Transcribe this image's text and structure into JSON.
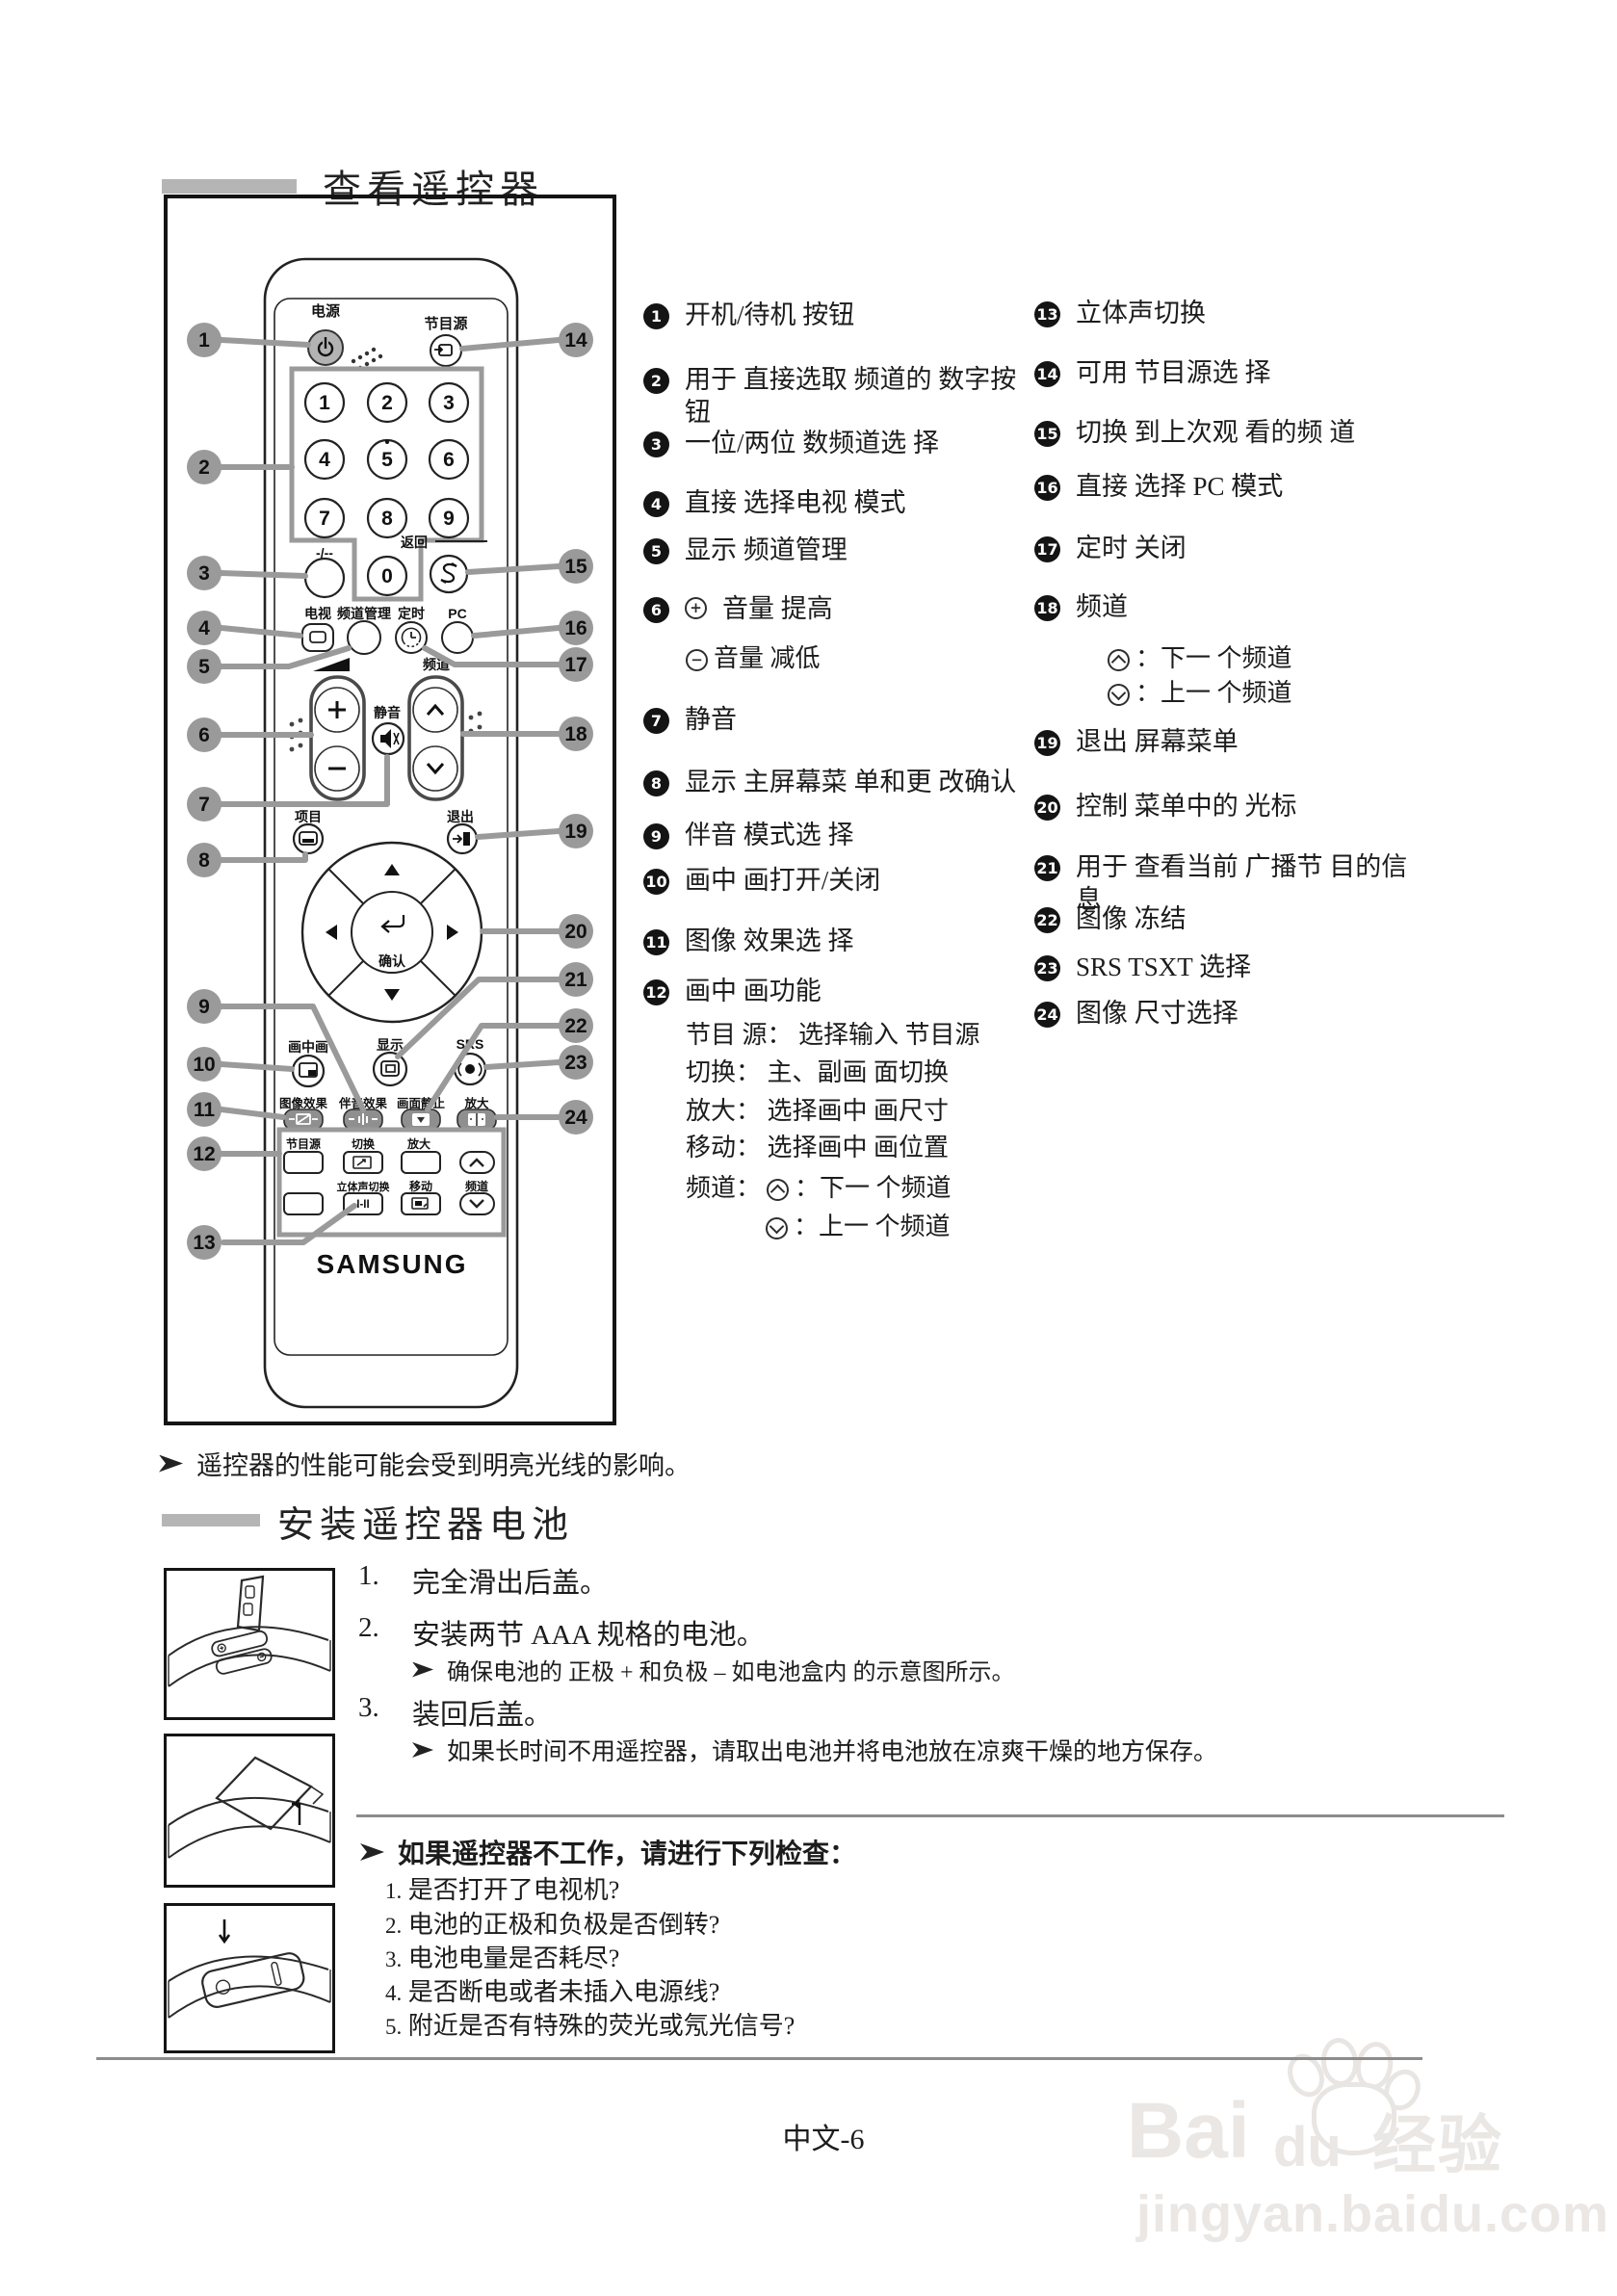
{
  "page": {
    "title1": "查看遥控器",
    "footer": "中文-6"
  },
  "nums": [
    "1",
    "2",
    "3",
    "4",
    "5",
    "6",
    "7",
    "8",
    "9",
    "10",
    "11",
    "12",
    "13",
    "14",
    "15",
    "16",
    "17",
    "18",
    "19",
    "20",
    "21",
    "22",
    "23",
    "24"
  ],
  "remote": {
    "power_label": "电源",
    "source_label": "节目源",
    "digits": [
      "1",
      "2",
      "3",
      "4",
      "5",
      "6",
      "7",
      "8",
      "9",
      "0"
    ],
    "dash_label": "-/--",
    "return_label": "返回",
    "tv": "电视",
    "ch_mgr": "频道管理",
    "timer": "定时",
    "pc": "PC",
    "mute": "静音",
    "channel": "频道",
    "item": "项目",
    "exit": "退出",
    "confirm": "确认",
    "pip": "画中画",
    "display": "显示",
    "srs": "SRS",
    "pic_effect": "图像效果",
    "sound_effect": "伴音效果",
    "still": "画面静止",
    "zoom": "放大",
    "g_source": "节目源",
    "g_swap": "切换",
    "g_size": "放大",
    "g_stereo": "立体声切换",
    "g_ii": "I-II",
    "g_move": "移动",
    "g_channel": "频道",
    "brand": "SAMSUNG"
  },
  "legend": {
    "i1": "开机/待机 按钮",
    "i2": "用于 直接选取 频道的 数字按 钮",
    "i3": "一位/两位 数频道选 择",
    "i4": "直接 选择电视 模式",
    "i5": "显示 频道管理",
    "i6_up": "音量 提高",
    "i6_down": "音量 减低",
    "i7": "静音",
    "i8": "显示 主屏幕菜 单和更 改确认",
    "i9": "伴音 模式选 择",
    "i10": "画中 画打开/关闭",
    "i11": "图像 效果选 择",
    "i12": "画中 画功能",
    "i12_source": "节目 源： 选择输入 节目源",
    "i12_swap": "切换： 主、副画 面切换",
    "i12_size": "放大： 选择画中 画尺寸",
    "i12_move": "移动： 选择画中 画位置",
    "i12_chan": "频道：",
    "i12_chan_up": "：下一 个频道",
    "i12_chan_down": "：上一 个频道",
    "i13": "立体声切换",
    "i14": "可用 节目源选 择",
    "i15": "切换 到上次观 看的频 道",
    "i16": "直接 选择 PC 模式",
    "i17": "定时 关闭",
    "i18": "频道",
    "i18_up": "：下一 个频道",
    "i18_down": "：上一 个频道",
    "i19": "退出 屏幕菜单",
    "i20": "控制 菜单中的 光标",
    "i21": "用于 查看当前 广播节 目的信 息",
    "i22": "图像 冻结",
    "i23": "SRS TSXT 选择",
    "i24": "图像 尺寸选择"
  },
  "install": {
    "note": "遥控器的性能可能会受到明亮光线的影响。",
    "title": "安装遥控器电池",
    "s1n": "1.",
    "s1": "完全滑出后盖。",
    "s2n": "2.",
    "s2": "安装两节 AAA  规格的电池。",
    "s2note": "确保电池的 正极 + 和负极 – 如电池盒内 的示意图所示。",
    "s3n": "3.",
    "s3": "装回后盖。",
    "s3note": "如果长时间不用遥控器，请取出电池并将电池放在凉爽干燥的地方保存。",
    "check_title": "如果遥控器不工作，请进行下列检查：",
    "c1n": "1.",
    "c1": "是否打开了电视机?",
    "c2n": "2.",
    "c2": "电池的正极和负极是否倒转?",
    "c3n": "3.",
    "c3": "电池电量是否耗尽?",
    "c4n": "4.",
    "c4": "是否断电或者未插入电源线?",
    "c5n": "5.",
    "c5": "附近是否有特殊的荧光或氖光信号?"
  },
  "watermark": {
    "bai": "Bai",
    "du": "du",
    "jingyan": "经验",
    "url": "jingyan.baidu.com"
  }
}
